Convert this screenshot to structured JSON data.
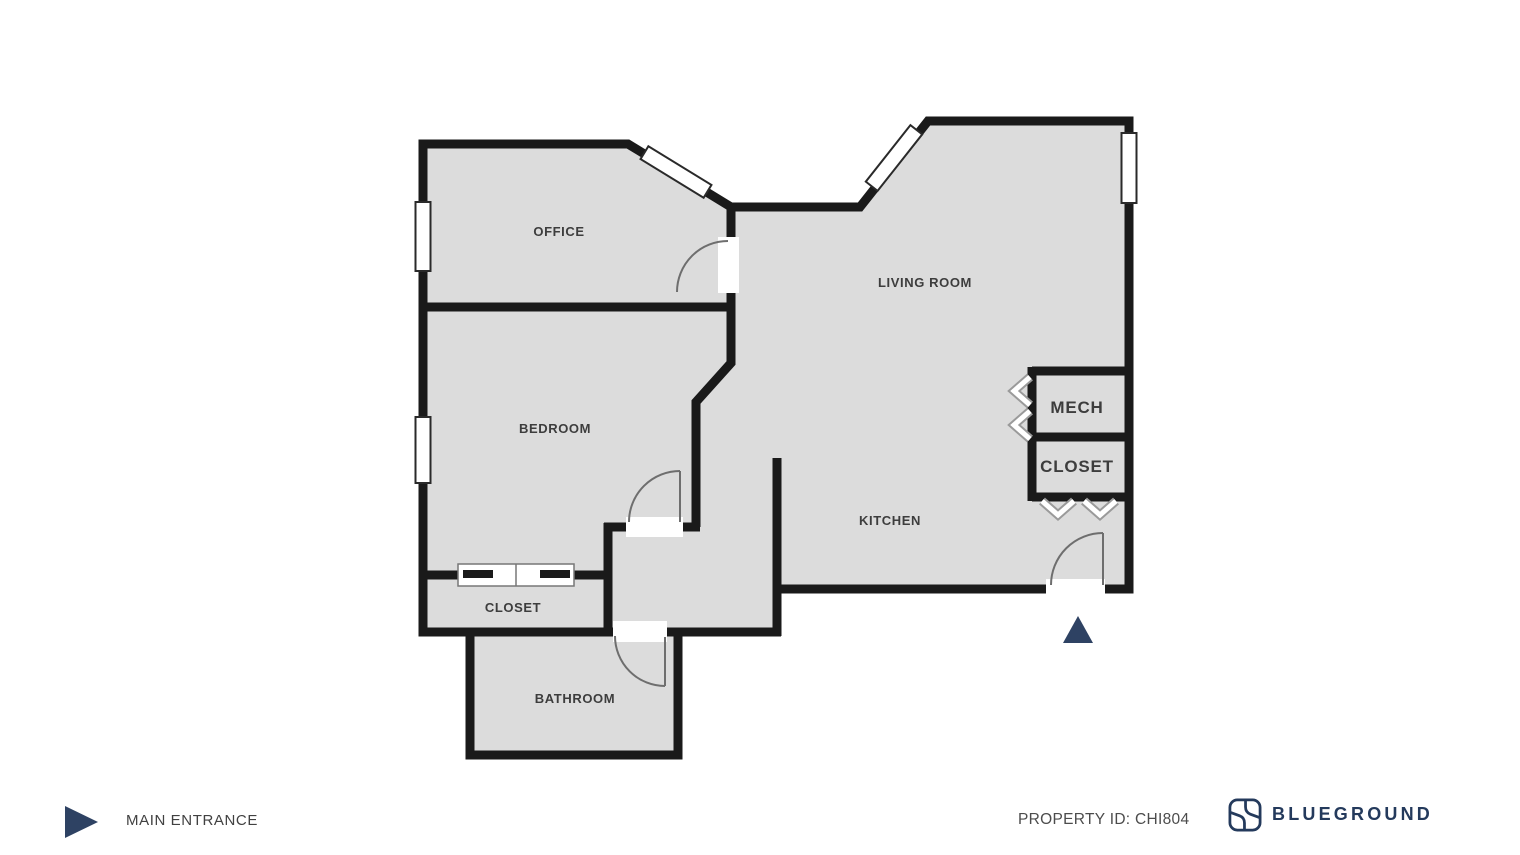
{
  "floor_plan": {
    "rooms": [
      {
        "id": "office",
        "label": "OFFICE"
      },
      {
        "id": "living-room",
        "label": "LIVING ROOM"
      },
      {
        "id": "bedroom",
        "label": "BEDROOM"
      },
      {
        "id": "kitchen",
        "label": "KITCHEN"
      },
      {
        "id": "mech",
        "label": "MECH"
      },
      {
        "id": "closet-hall",
        "label": "CLOSET"
      },
      {
        "id": "closet-bedroom",
        "label": "CLOSET"
      },
      {
        "id": "bathroom",
        "label": "BATHROOM"
      }
    ],
    "colors": {
      "floor_fill": "#dcdcdc",
      "wall": "#1a1a1a",
      "label_text": "#3d3d3d",
      "door_arc": "#6e6e6e",
      "accent_navy": "#2e4263",
      "brand_navy": "#243a5c"
    }
  },
  "legend": {
    "main_entrance_label": "MAIN ENTRANCE"
  },
  "footer": {
    "property_id_label": "PROPERTY ID: CHI804",
    "brand_name": "BLUEGROUND"
  }
}
